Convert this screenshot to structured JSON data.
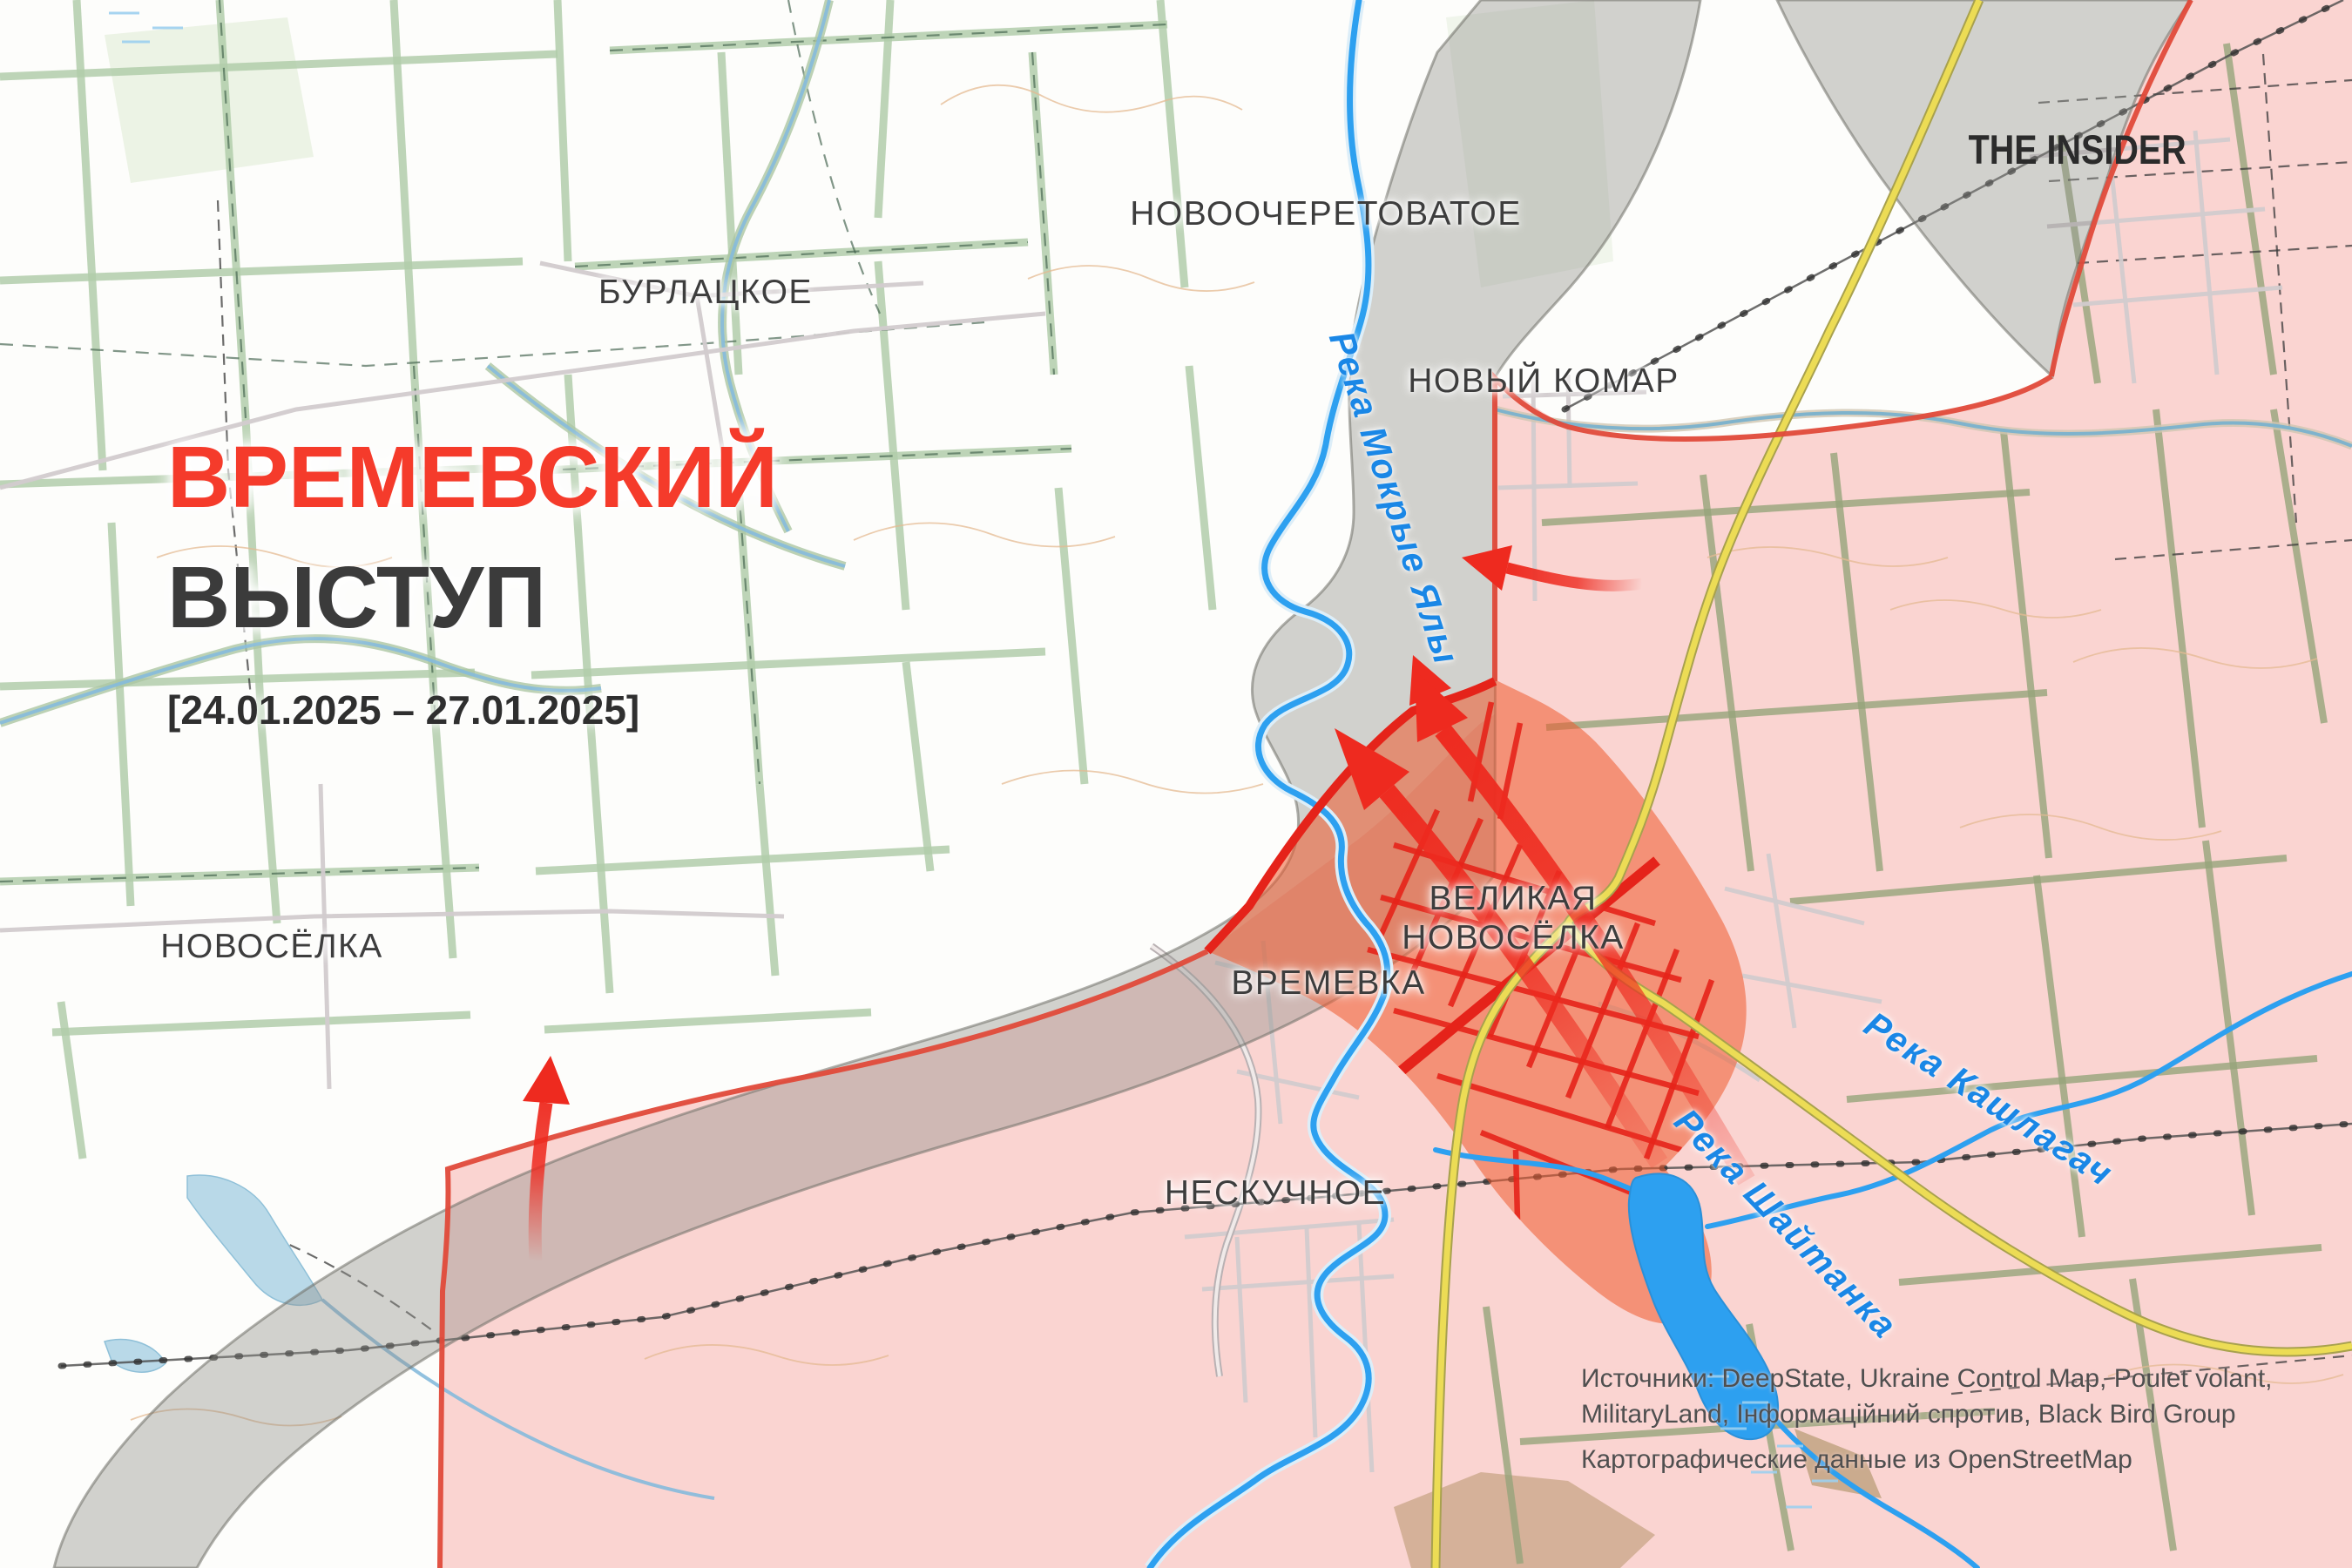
{
  "header": {
    "title_line1": "ВРЕМЕВСКИЙ",
    "title_line2": "ВЫСТУП",
    "date_range": "[24.01.2025 – 27.01.2025]"
  },
  "branding": {
    "logo": "THE INSIDER"
  },
  "places": {
    "novoocheretovatoe": "НОВООЧЕРЕТОВАТОЕ",
    "burlatskoe": "БУРЛАЦКОЕ",
    "novy_komar": "НОВЫЙ КОМАР",
    "velikaya_novosyolka_line1": "ВЕЛИКАЯ",
    "velikaya_novosyolka_line2": "НОВОСЁЛКА",
    "vremevka": "ВРЕМЕВКА",
    "novosyolka": "НОВОСЁЛКА",
    "neskuchnoe": "НЕСКУЧНОЕ"
  },
  "rivers": {
    "mokrye_yaly": "Река Мокрые Ялы",
    "kashlagach": "Река Кашлагач",
    "shaytanka": "Река Шайтанка"
  },
  "credits": {
    "sources_line1": "Источники: DeepState, Ukraine Control Map, Poulet volant,",
    "sources_line2": "MilitaryLand, Інформаційний спротив, Black Bird Group",
    "map_data": "Картографические данные из OpenStreetMap"
  },
  "legend_colors": {
    "occupied_fill": "#f49693",
    "occupied_border": "#e04a3a",
    "advance_fill": "#ef5a2e",
    "advance_streets": "#e5231a",
    "arrow": "#ee2a1f",
    "river": "#2da0f0",
    "road_major": "#ecdc55",
    "title_accent": "#f53b2b"
  }
}
